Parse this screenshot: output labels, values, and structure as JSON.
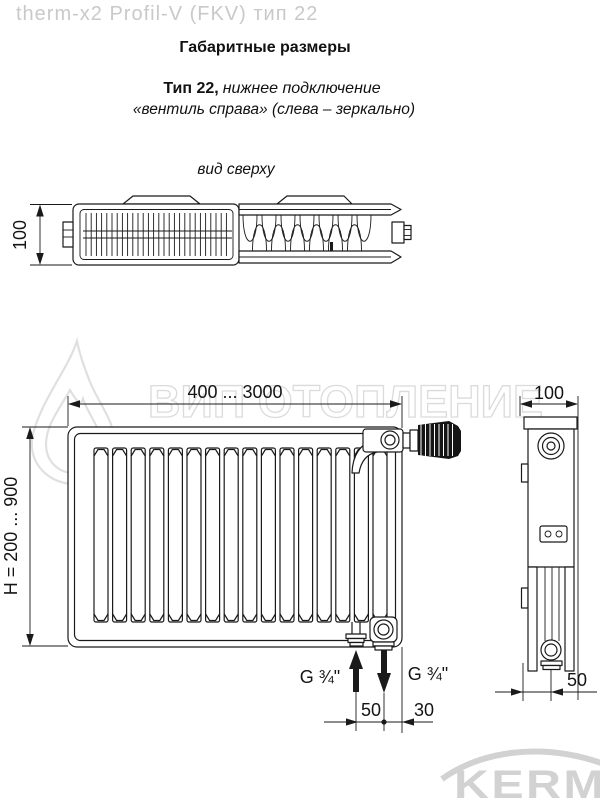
{
  "header": {
    "brand_line": "therm-x2 Profil-V (FKV) тип 22",
    "title": "Габаритные размеры",
    "subtitle_bold": "Тип 22,",
    "subtitle_italic": "нижнее подключение",
    "subtitle_line2": "«вентиль справа» (слева – зеркально)"
  },
  "top_view": {
    "label": "вид сверху",
    "dim_height": "100"
  },
  "front_view": {
    "dim_length": "400 ... 3000",
    "dim_height": "H = 200 ... 900",
    "conn_left_label": "G ¾\"",
    "conn_right_label": "G ¾\"",
    "dim_conn_spacing": "50",
    "dim_conn_offset": "30"
  },
  "side_view": {
    "dim_depth": "100",
    "dim_conn": "50"
  },
  "watermark": {
    "text": "ВИП ОТОПЛЕНИЕ"
  },
  "logo": {
    "text": "KERMI"
  },
  "colors": {
    "line": "#1a1a1a",
    "brand_gray": "#c9c9c9",
    "watermark_gray": "#dbdbdb",
    "logo_gray": "#d2d2d2"
  }
}
